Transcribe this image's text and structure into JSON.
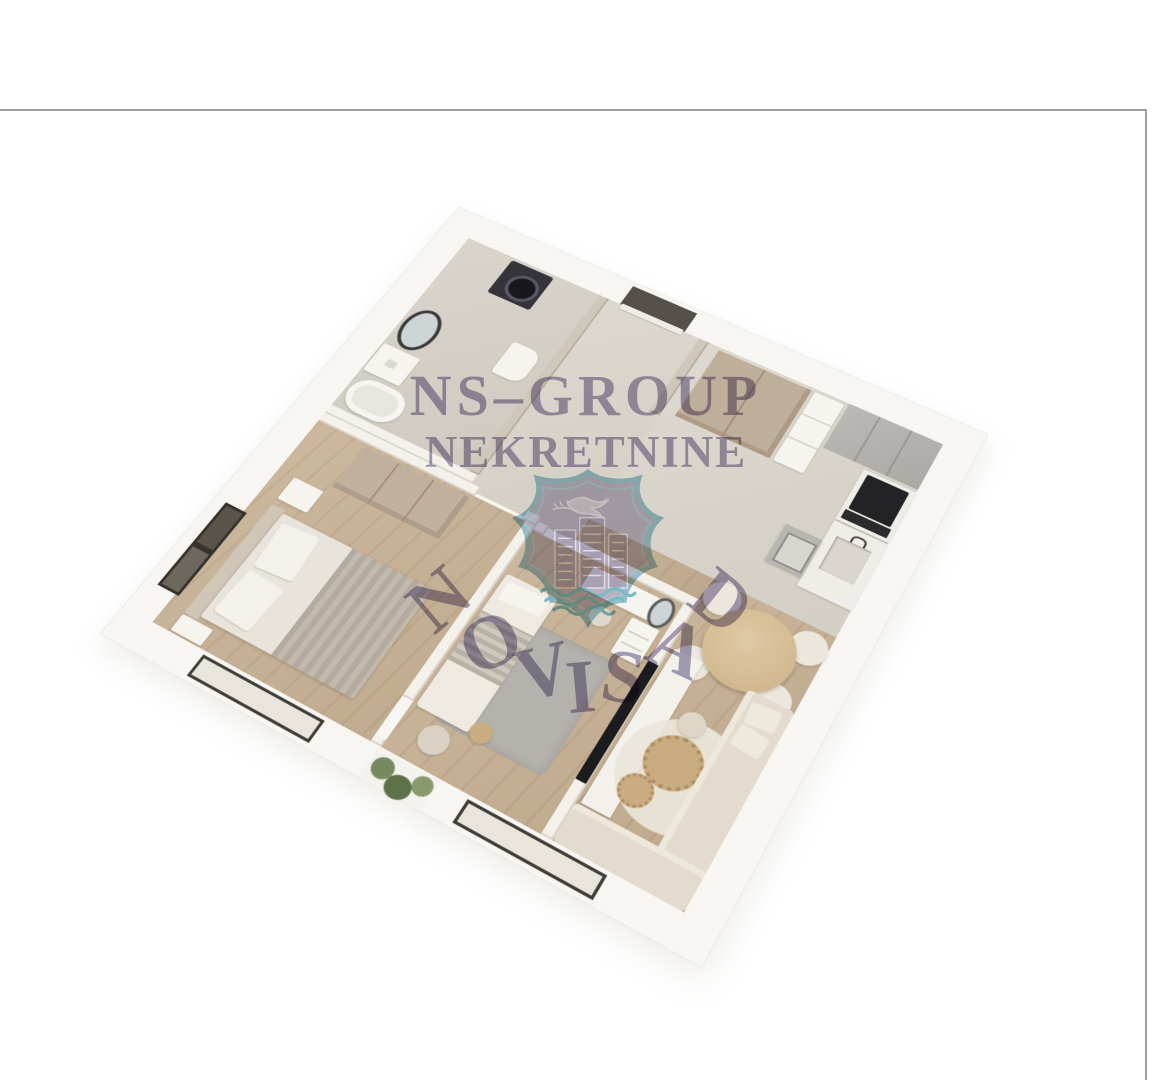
{
  "watermark": {
    "line1": "NS–GROUP",
    "line2": "NEKRETNINE",
    "arc_word": "NOVI SAD",
    "arc_letters": [
      "N",
      "O",
      "V",
      "I",
      "S",
      "A",
      "D"
    ],
    "text_color": "#6f6492",
    "shield": {
      "border_color": "#9cc7d6",
      "fill_color": "#847aa6",
      "wave_color": "#7fc3d2",
      "emblem": "dove-and-branch-over-city-skyline-above-waves"
    }
  },
  "frame": {
    "line_color": "#9f9f9f"
  },
  "palette": {
    "background": "#ffffff",
    "outer_wall": "#f8f6f2",
    "interior_wall": "#f4f1eb",
    "wall_face_gray": "#cfc7b9",
    "tile_floor": "#d9d4cb",
    "wood_floor": "#c3ae92",
    "wardrobe_tan": "#bfae9a",
    "kitchen_cabinet_gray": "#b6b3ae",
    "appliance_black": "#2b2a2d",
    "sofa_beige": "#e3dcce",
    "rug_gray": "#b5b1ac",
    "rug_cream": "#ece6da",
    "coffee_table_wood": "#c8ab7e",
    "plant_green": "#6d7f57"
  }
}
